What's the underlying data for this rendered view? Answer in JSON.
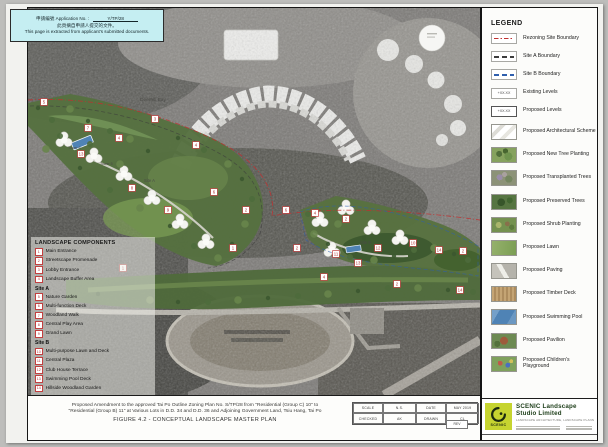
{
  "notice": {
    "line1_prefix": "申請編號 Application No. :",
    "app_no": "Y/TP/28",
    "line2": "此頁摘自申請人提交的文件。",
    "line3": "This page is extracted from applicant's submitted documents."
  },
  "legend": {
    "title": "LEGEND",
    "items": [
      {
        "type": "line-red",
        "label": "Rezoning Site Boundary"
      },
      {
        "type": "line-black",
        "label": "Site A Boundary"
      },
      {
        "type": "line-blue",
        "label": "Site B Boundary"
      },
      {
        "type": "level-existing",
        "label": "Existing Levels",
        "symbol_text": "+XX.XX"
      },
      {
        "type": "level-proposed",
        "label": "Proposed Levels",
        "symbol_text": "+XX.XX"
      },
      {
        "type": "swatch-arch",
        "label": "Proposed Architectural Scheme"
      },
      {
        "type": "swatch-newtree",
        "label": "Proposed New Tree Planting"
      },
      {
        "type": "swatch-transplanted",
        "label": "Proposed Transplanted Trees"
      },
      {
        "type": "swatch-preserved",
        "label": "Proposed Preserved Trees"
      },
      {
        "type": "swatch-shrub",
        "label": "Proposed Shrub Planting"
      },
      {
        "type": "swatch-lawn",
        "label": "Proposed Lawn"
      },
      {
        "type": "swatch-paving",
        "label": "Proposed Paving"
      },
      {
        "type": "swatch-timber",
        "label": "Proposed Timber Deck"
      },
      {
        "type": "swatch-pool",
        "label": "Proposed Swimming Pool"
      },
      {
        "type": "swatch-pavilion",
        "label": "Proposed Pavilion"
      },
      {
        "type": "swatch-playground",
        "label": "Proposed Children's Playground"
      }
    ]
  },
  "components": {
    "title": "LANDSCAPE COMPONENTS",
    "rows": [
      {
        "num": "1",
        "label": "Main Entrance"
      },
      {
        "num": "2",
        "label": "Streetscape Promenade"
      },
      {
        "num": "3",
        "label": "Lobby Entrance"
      },
      {
        "num": "4",
        "label": "Landscape Buffer Area"
      },
      {
        "heading": "Site A"
      },
      {
        "num": "5",
        "label": "Nature Garden"
      },
      {
        "num": "6",
        "label": "Multi-function Deck"
      },
      {
        "num": "7",
        "label": "Woodland Walk"
      },
      {
        "num": "8",
        "label": "Central Play Area"
      },
      {
        "num": "9",
        "label": "Grand Lawn"
      },
      {
        "heading": "Site B"
      },
      {
        "num": "10",
        "label": "Multi-purpose Lawn and Deck"
      },
      {
        "num": "11",
        "label": "Central Plaza"
      },
      {
        "num": "12",
        "label": "Club House Terrace"
      },
      {
        "num": "13",
        "label": "Swimming Pool Deck"
      },
      {
        "num": "14",
        "label": "Hillside Woodland Garden"
      }
    ]
  },
  "map": {
    "labels": [
      {
        "text": "Deerhill Bay",
        "x": 112,
        "y": 93,
        "size": 4.8
      },
      {
        "text": "Tower 6",
        "x": 40,
        "y": 141,
        "size": 3.6
      },
      {
        "text": "Tower 5",
        "x": 72,
        "y": 157,
        "size": 3.6
      },
      {
        "text": "Site A",
        "x": 116,
        "y": 174,
        "size": 4.2
      },
      {
        "text": "Site B",
        "x": 332,
        "y": 236,
        "size": 4.2
      }
    ],
    "markers": [
      {
        "n": "5",
        "x": 16,
        "y": 94
      },
      {
        "n": "3",
        "x": 127,
        "y": 111
      },
      {
        "n": "4",
        "x": 91,
        "y": 130
      },
      {
        "n": "13",
        "x": 53,
        "y": 146
      },
      {
        "n": "4",
        "x": 168,
        "y": 137
      },
      {
        "n": "7",
        "x": 60,
        "y": 120
      },
      {
        "n": "6",
        "x": 186,
        "y": 184
      },
      {
        "n": "8",
        "x": 104,
        "y": 180
      },
      {
        "n": "9",
        "x": 140,
        "y": 202
      },
      {
        "n": "2",
        "x": 218,
        "y": 202
      },
      {
        "n": "6",
        "x": 258,
        "y": 202
      },
      {
        "n": "4",
        "x": 287,
        "y": 205
      },
      {
        "n": "2",
        "x": 318,
        "y": 211
      },
      {
        "n": "1",
        "x": 205,
        "y": 240
      },
      {
        "n": "2",
        "x": 269,
        "y": 240
      },
      {
        "n": "10",
        "x": 385,
        "y": 235
      },
      {
        "n": "14",
        "x": 411,
        "y": 242
      },
      {
        "n": "2",
        "x": 435,
        "y": 243
      },
      {
        "n": "13",
        "x": 330,
        "y": 255
      },
      {
        "n": "4",
        "x": 296,
        "y": 269
      },
      {
        "n": "2",
        "x": 369,
        "y": 276
      },
      {
        "n": "14",
        "x": 432,
        "y": 282
      },
      {
        "n": "1",
        "x": 95,
        "y": 260
      },
      {
        "n": "11",
        "x": 308,
        "y": 246
      },
      {
        "n": "12",
        "x": 350,
        "y": 240
      }
    ]
  },
  "title_block": {
    "line1": "Proposed Amendment to the approved Tai Po Outline Zoning Plan No. S/TP/28 from \"Residential (Group C) 10\" to",
    "line2": "\"Residential (Group B) 11\" at Various Lots in D.D. 34 and D.D. 36 and Adjoining Government Land, Tsiu Hang, Tai Po",
    "figure": "FIGURE 4.2 - CONCEPTUAL LANDSCAPE MASTER PLAN",
    "table": {
      "scale_label": "SCALE",
      "scale_value": "N.S.",
      "date_label": "DATE",
      "date_value": "MAY 2019",
      "checked_label": "CHECKED",
      "checked_value": "AK",
      "drawn_label": "DRAWN",
      "drawn_value": "CL",
      "rev_label": "REV"
    }
  },
  "studio": {
    "name": "SCENIC Landscape Studio Limited",
    "tagline": "LANDSCAPE ARCHITECTURE, LANDSCAPE PLANNING & ASSESSMENT",
    "logo_text": "SCENIC"
  },
  "colors": {
    "notice_bg": "#c5eef2",
    "rezoning_red": "#c03030",
    "site_b_blue": "#2f5fae",
    "marker_red": "#c24040",
    "logo_green": "#c6d430"
  }
}
